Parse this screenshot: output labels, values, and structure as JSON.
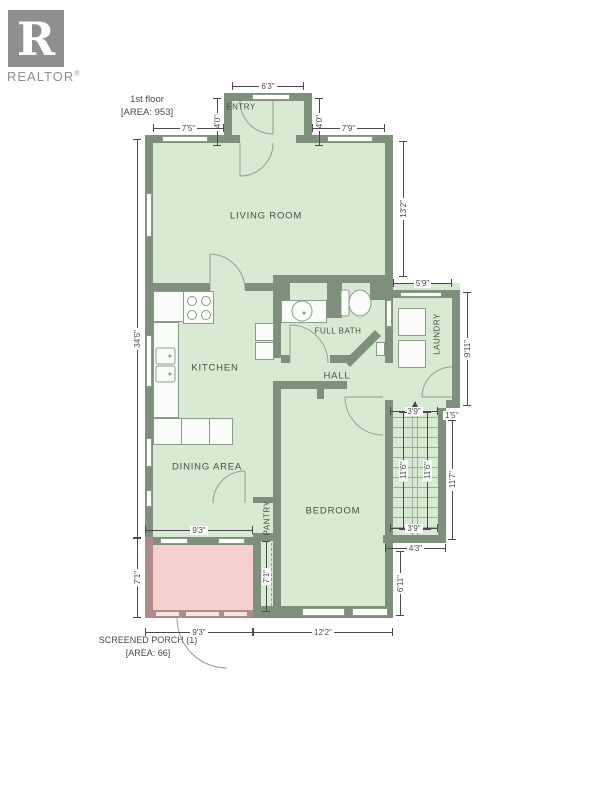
{
  "logo": {
    "letter": "R",
    "brand": "REALTOR",
    "registered": "®"
  },
  "floor_label": {
    "title": "1st floor",
    "area": "[AREA: 953]"
  },
  "porch_label": {
    "title": "SCREENED PORCH (1)",
    "area": "[AREA: 66]"
  },
  "rooms": {
    "entry": "ENTRY",
    "living_room": "LIVING ROOM",
    "kitchen": "KITCHEN",
    "full_bath": "FULL BATH",
    "hall": "HALL",
    "laundry": "LAUNDRY",
    "dining_area": "DINING AREA",
    "pantry": "PANTRY",
    "bedroom": "BEDROOM"
  },
  "dimensions": {
    "entry_width": "6'3\"",
    "entry_side_left": "4'0\"",
    "entry_side_right": "4'0\"",
    "front_left": "7'5\"",
    "front_right": "7'9\"",
    "living_depth": "13'2\"",
    "house_depth": "34'5\"",
    "laundry_width": "5'9\"",
    "laundry_depth": "9'11\"",
    "stairs_width_top": "3'9\"",
    "stairs_jog": "1'5\"",
    "stairs_run_left": "11'6\"",
    "stairs_run_right": "11'6\"",
    "stairs_outer": "11'7\"",
    "stairs_width_bottom": "3'9\"",
    "stairs_below": "4'3\"",
    "bedroom_depth": "6'11\"",
    "porch_width_top": "9'3\"",
    "porch_depth_left": "7'1\"",
    "corridor_depth": "7'1\"",
    "porch_width_bottom": "9'3\"",
    "bedroom_width": "12'2\""
  },
  "colors": {
    "wall": "#7e907c",
    "room": "#d8e9d4",
    "porch-wall": "#ab8c8b",
    "porch": "#f6d0ce",
    "line": "#4a4a4a",
    "label": "#44523f",
    "window": "#fcfefa",
    "porch-window": "#f9e3e1",
    "fixture-line": "#8b9b89",
    "logo-gray": "#8f8f8f",
    "text": "#4a4a4a"
  }
}
